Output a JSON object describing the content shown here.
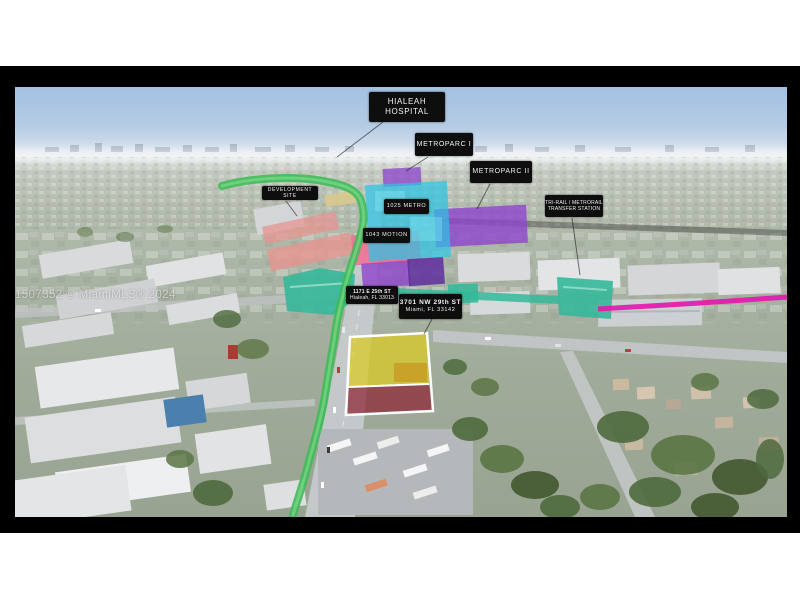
{
  "watermark": "A11507352 © MiamiMLS® 2024",
  "labels": {
    "hialeah_hospital": {
      "line1": "HIALEAH",
      "line2": "HOSPITAL"
    },
    "metroparc_i": {
      "text": "METROPARC I"
    },
    "metroparc_ii": {
      "text": "METROPARC II"
    },
    "development_site": {
      "text": "DEVELOPMENT SITE"
    },
    "metro_1025": {
      "text": "1025 METRO"
    },
    "motion_1043": {
      "text": "1043 MOTION"
    },
    "transfer_station": {
      "line1": "TRI-RAIL / METRORAIL",
      "line2": "TRANSFER STATION"
    },
    "address_hialeah": {
      "line1": "1171 E 25th ST",
      "line2": "Hialeah, FL 33013"
    },
    "address_subject": {
      "line1": "3701 NW 29th ST",
      "line2": "Miami, FL 33142"
    }
  },
  "colors": {
    "corridor_green": "#3dbb57",
    "corridor_green_light": "#8fe39a",
    "station_teal": "#35b89a",
    "development_pink": "#e8938f",
    "highlight_pink": "#f2688c",
    "metroparc_purple": "#8e44cc",
    "metro_cyan": "#29c5e6",
    "rail_magenta": "#e319ac",
    "subject_yellow": "#ddca1e",
    "subject_red": "#8c2433"
  }
}
